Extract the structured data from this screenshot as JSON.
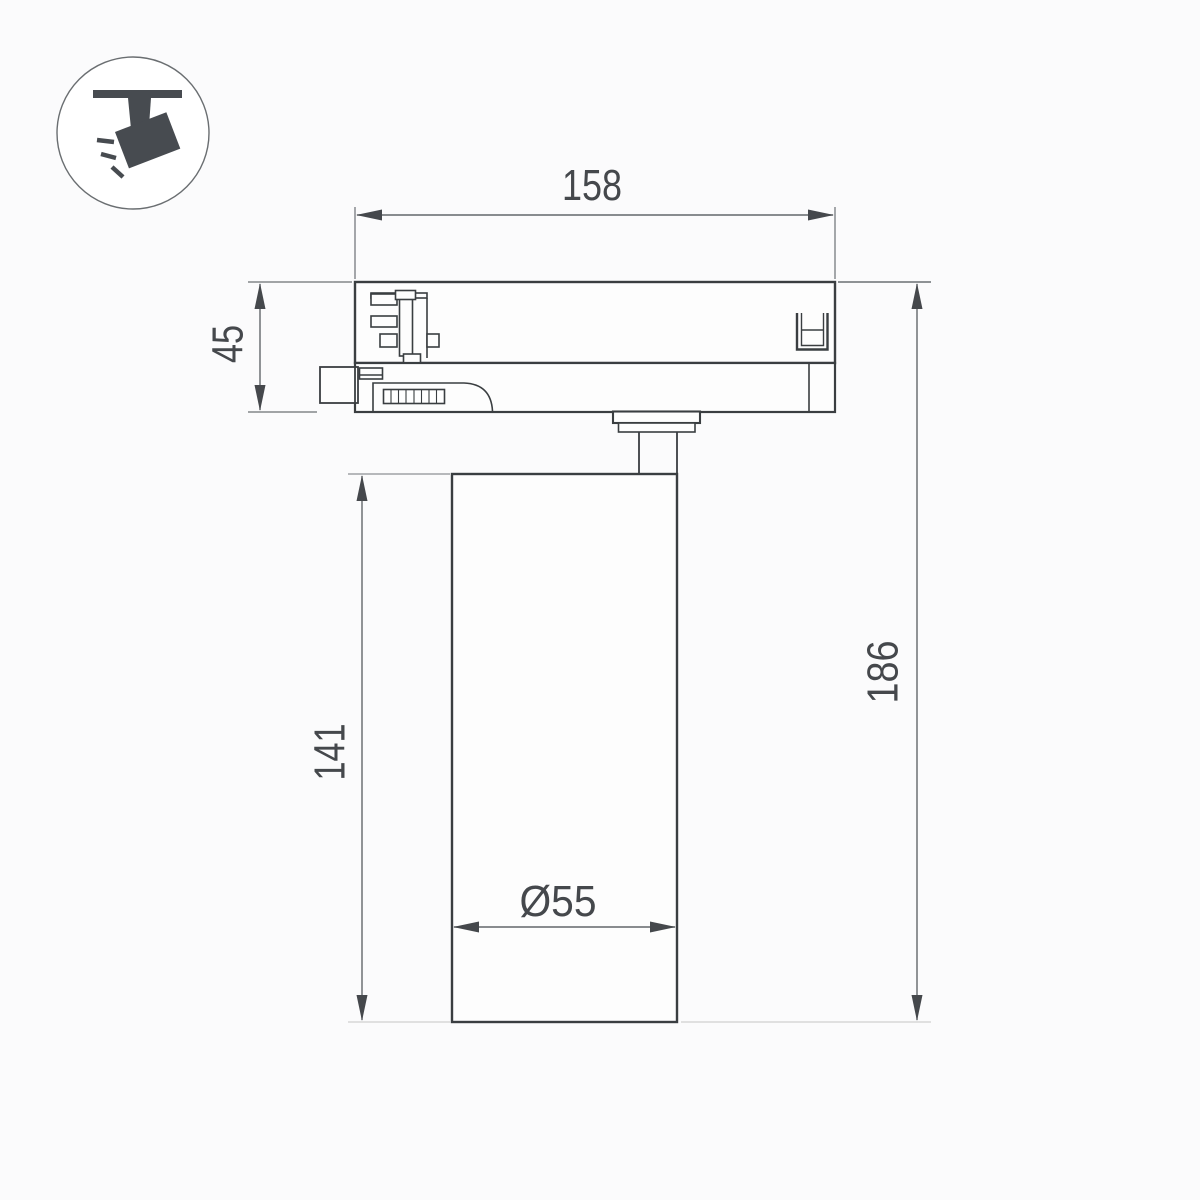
{
  "page": {
    "type": "technical-dimension-drawing",
    "subject": "led-track-spotlight-side-view",
    "background": "#fbfbfc"
  },
  "icon": {
    "name": "track-spotlight-icon",
    "description": "ceiling track with tilted spotlight head and light rays",
    "color": "#474b50"
  },
  "dimensions": {
    "track_adapter_width": "158",
    "track_adapter_height": "45",
    "lamp_body_height": "141",
    "total_height": "186",
    "lamp_body_diameter": "Ø55"
  },
  "colors": {
    "outline": "#3a3e41",
    "dimension_line": "#63676b",
    "dimension_text": "#45484c",
    "light_extension_line": "#d7d7d7",
    "fill": "#fdfdfd"
  }
}
